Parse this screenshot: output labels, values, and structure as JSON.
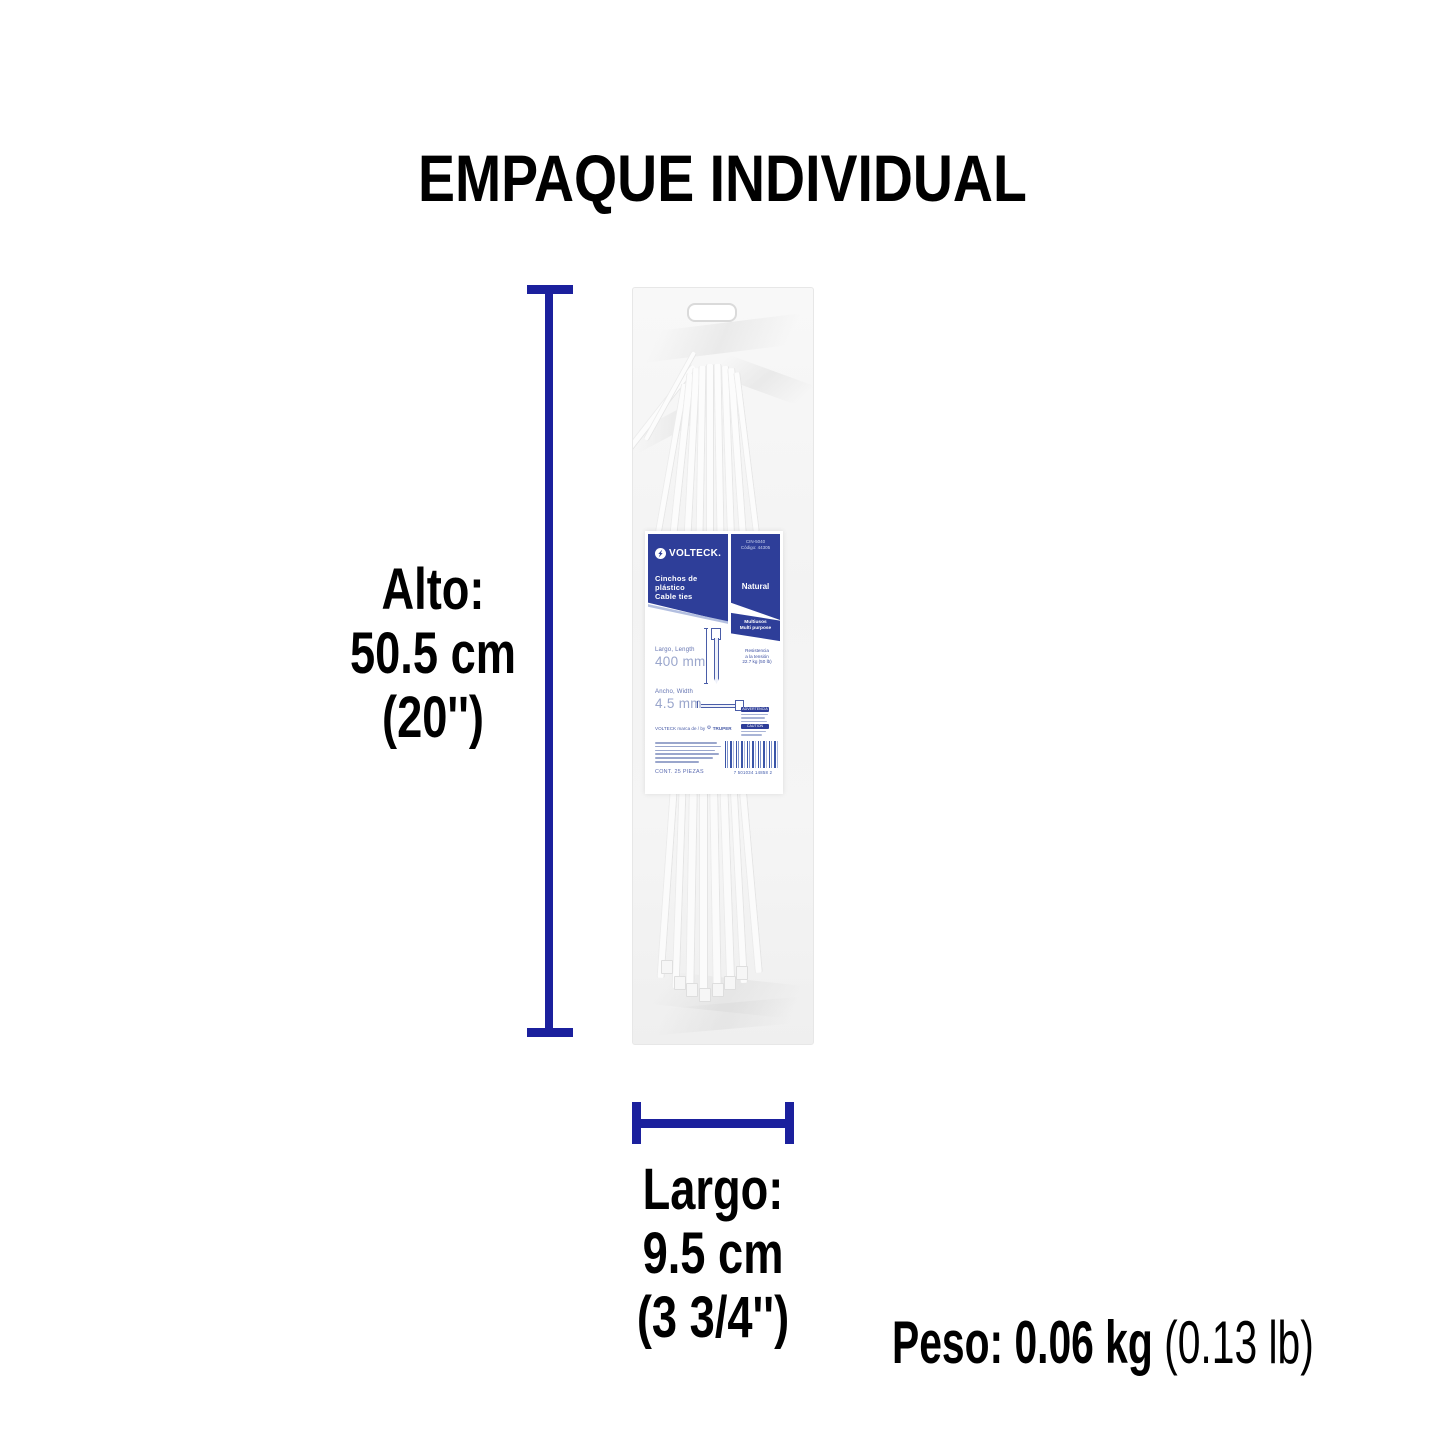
{
  "title": "EMPAQUE INDIVIDUAL",
  "accent_color": "#1b209d",
  "label_blue": "#2e3e99",
  "dims": {
    "alto": {
      "label": "Alto:",
      "metric": "50.5 cm",
      "imperial": "(20'')"
    },
    "largo": {
      "label": "Largo:",
      "metric": "9.5 cm",
      "imperial": "(3 3/4'')"
    },
    "peso": {
      "bold": "Peso: 0.06 kg",
      "light": " (0.13 lb)"
    }
  },
  "package_label": {
    "brand": "VOLTECK.",
    "model": "CIN-5040",
    "code": "Código: 44305",
    "product_line1": "Cinchos de plástico",
    "product_line2": "Cable ties",
    "finish": "Natural",
    "use_line1": "Multiusos",
    "use_line2": "Multi purpose",
    "spec_length_label": "Largo, Length",
    "spec_length_value": "400 mm",
    "spec_width_label": "Ancho, Width",
    "spec_width_value": "4.5 mm",
    "tension": [
      "Resistencia",
      "a la tensión",
      "22.7 kg (50 lb)"
    ],
    "warning_chip": "ADVERTENCIA",
    "caution_chip": "CAUTION",
    "licensee_prefix": "VOLTECK marca de / by",
    "licensee_brand": "TRUPER",
    "content_line": "CONT. 25 PIEZAS",
    "barcode_number": "7 501034 14858 2"
  }
}
